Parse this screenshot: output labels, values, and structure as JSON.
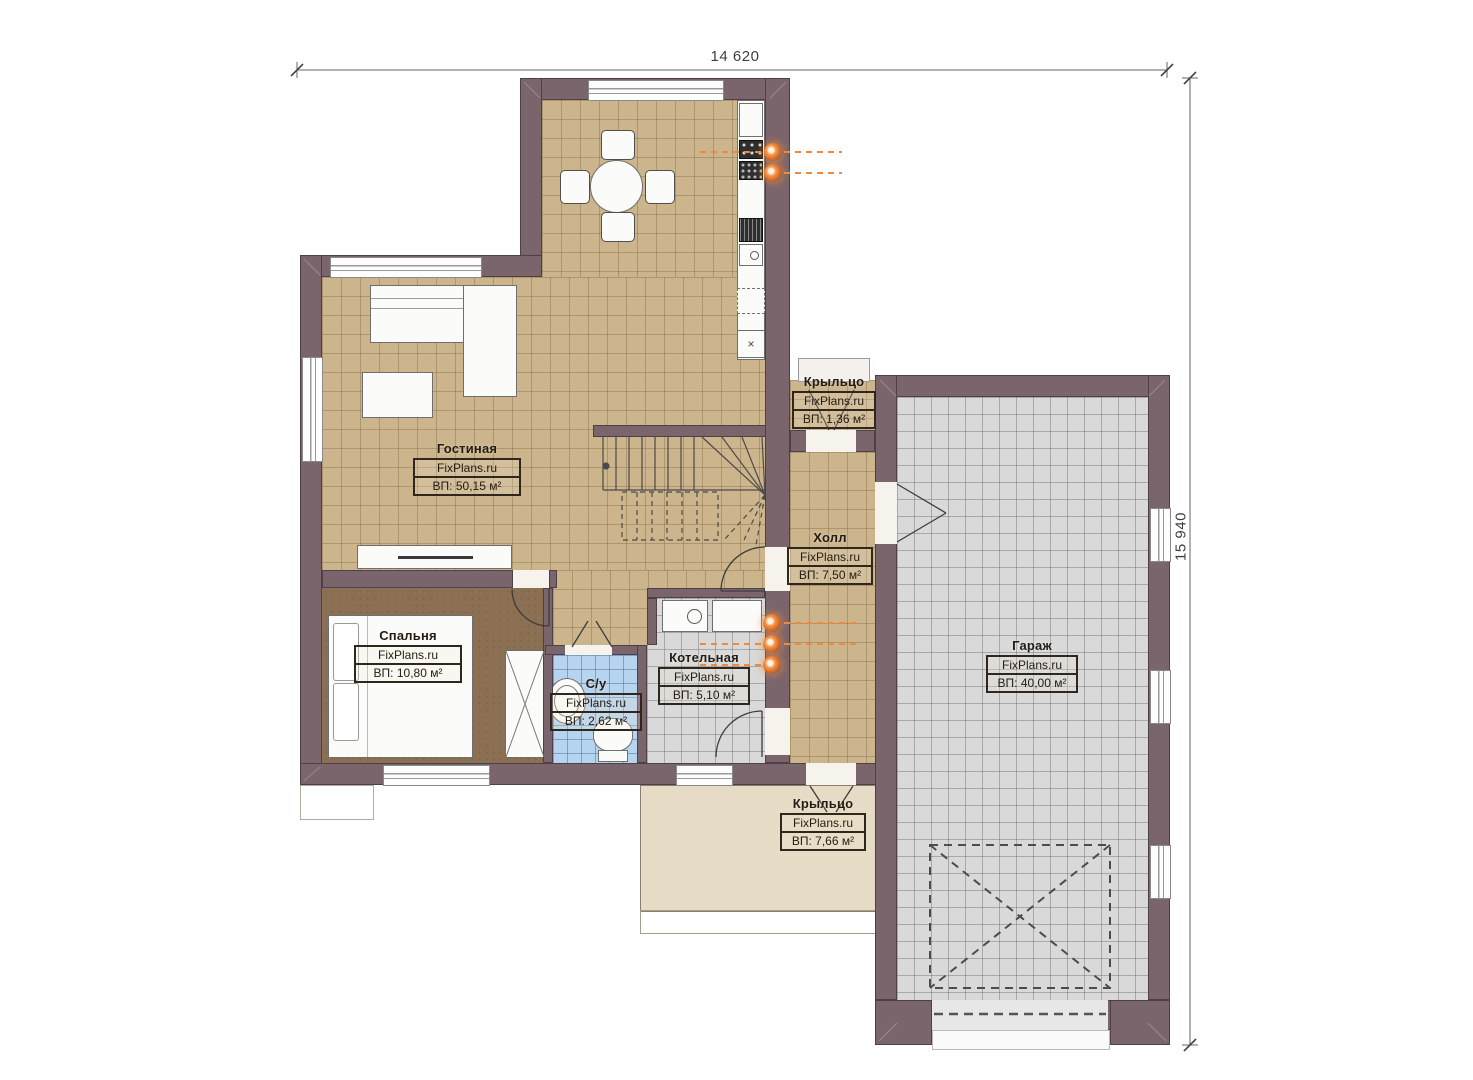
{
  "plan": {
    "dimensions": {
      "top": "14 620",
      "right": "15 940"
    },
    "rooms": [
      {
        "name": "Гостиная",
        "brand": "FixPlans.ru",
        "area": "ВП: 50,15 м²"
      },
      {
        "name": "Спальня",
        "brand": "FixPlans.ru",
        "area": "ВП: 10,80 м²"
      },
      {
        "name": "С/у",
        "brand": "FixPlans.ru",
        "area": "ВП: 2,62 м²"
      },
      {
        "name": "Котельная",
        "brand": "FixPlans.ru",
        "area": "ВП: 5,10 м²"
      },
      {
        "name": "Холл",
        "brand": "FixPlans.ru",
        "area": "ВП: 7,50 м²"
      },
      {
        "name": "Гараж",
        "brand": "FixPlans.ru",
        "area": "ВП: 40,00 м²"
      },
      {
        "name": "Крыльцо",
        "brand": "FixPlans.ru",
        "area": "ВП: 1,36 м²"
      },
      {
        "name": "Крыльцо",
        "brand": "FixPlans.ru",
        "area": "ВП: 7,66 м²"
      }
    ],
    "colors": {
      "wall": "#7b656c",
      "floor_tan": "#ccb48c",
      "floor_gray": "#d9d9d9",
      "floor_blue": "#b6d3ef",
      "floor_bedroom": "#8b7053",
      "porch": "#e6dcc5",
      "radiator": "#d96a20"
    }
  }
}
